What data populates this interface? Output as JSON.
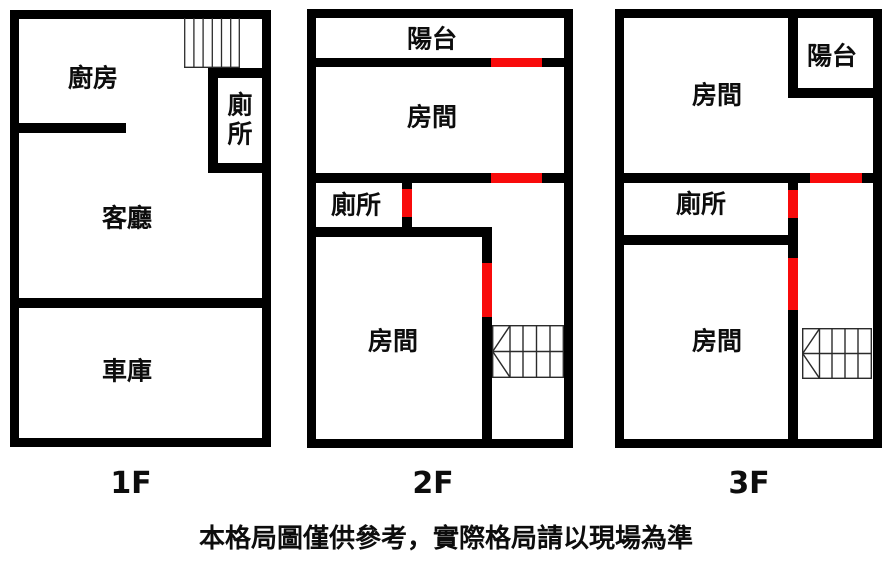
{
  "floors": [
    {
      "floor_label": "1F",
      "rooms": [
        {
          "name": "kitchen",
          "label": "廚房"
        },
        {
          "name": "toilet",
          "label": "廁所"
        },
        {
          "name": "living-room",
          "label": "客廳"
        },
        {
          "name": "garage",
          "label": "車庫"
        }
      ]
    },
    {
      "floor_label": "2F",
      "rooms": [
        {
          "name": "balcony",
          "label": "陽台"
        },
        {
          "name": "bedroom-top",
          "label": "房間"
        },
        {
          "name": "toilet",
          "label": "廁所"
        },
        {
          "name": "bedroom-bottom",
          "label": "房間"
        }
      ]
    },
    {
      "floor_label": "3F",
      "rooms": [
        {
          "name": "bedroom-top",
          "label": "房間"
        },
        {
          "name": "balcony",
          "label": "陽台"
        },
        {
          "name": "toilet",
          "label": "廁所"
        },
        {
          "name": "bedroom-bottom",
          "label": "房間"
        }
      ]
    }
  ],
  "disclaimer": "本格局圖僅供參考，實際格局請以現場為準",
  "colors": {
    "wall": "#000000",
    "door": "#f80b0b",
    "background": "#ffffff",
    "stair_line": "#2b2b2b"
  }
}
